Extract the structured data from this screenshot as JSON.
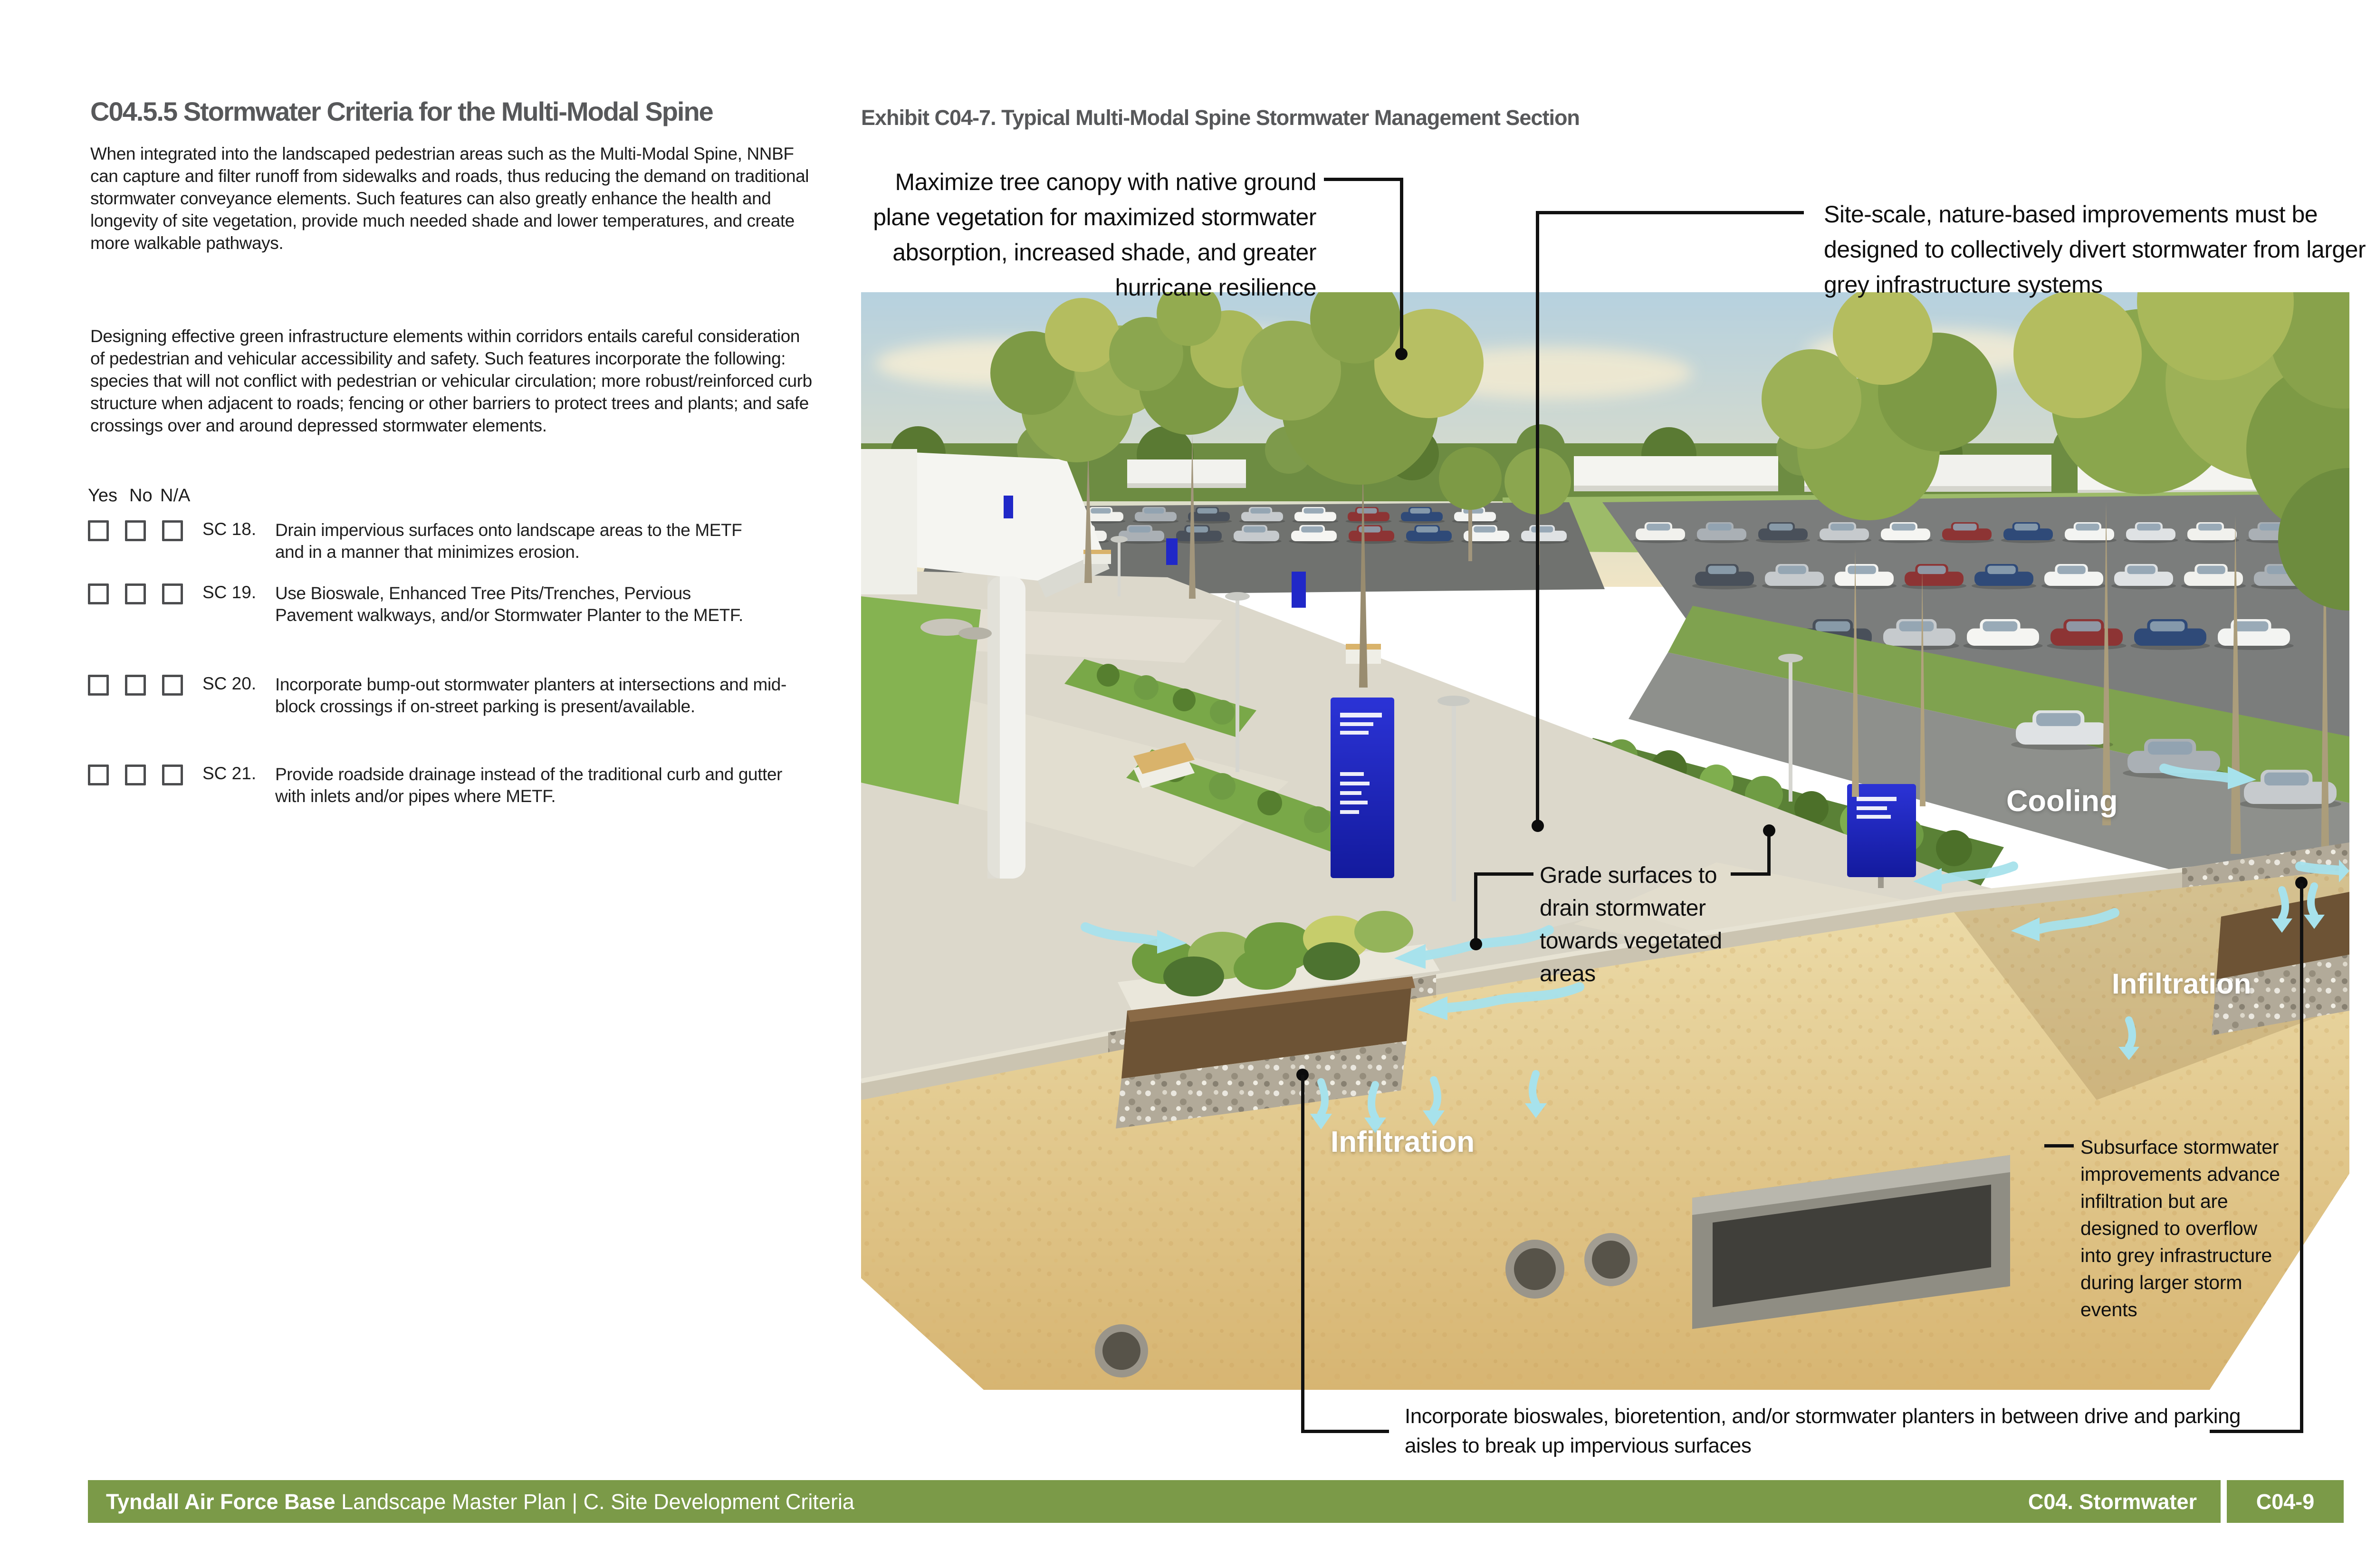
{
  "page": {
    "heading": "C04.5.5 Stormwater Criteria for the Multi-Modal Spine",
    "paragraphs": [
      "When integrated into the landscaped pedestrian areas such as the Multi-Modal Spine, NNBF can capture and filter runoff from sidewalks and roads, thus reducing the demand on traditional stormwater conveyance elements. Such features can also greatly enhance the health and longevity of site vegetation, provide much needed shade and lower temperatures, and create more walkable pathways.",
      "Designing effective green infrastructure elements within corridors entails careful consideration of pedestrian and vehicular accessibility and safety. Such features incorporate the following: species that will not conflict with pedestrian or vehicular circulation; more robust/reinforced curb structure when adjacent to roads; fencing or other barriers to protect trees and plants; and safe crossings over and around depressed stormwater elements."
    ],
    "checklist": {
      "column_headers": [
        "Yes",
        "No",
        "N/A"
      ],
      "items": [
        {
          "id": "SC 18.",
          "text": "Drain impervious surfaces onto landscape areas to the METF and in a manner that minimizes erosion."
        },
        {
          "id": "SC 19.",
          "text": "Use Bioswale, Enhanced Tree Pits/Trenches, Pervious Pavement walkways, and/or Stormwater Planter to the METF."
        },
        {
          "id": "SC 20.",
          "text": "Incorporate bump-out stormwater planters at intersections and mid-block crossings if on-street parking is present/available."
        },
        {
          "id": "SC 21.",
          "text": "Provide roadside drainage instead of the traditional curb and gutter with inlets and/or pipes where METF."
        }
      ]
    }
  },
  "exhibit": {
    "title": "Exhibit C04-7. Typical Multi-Modal Spine Stormwater Management Section",
    "annotations": {
      "tree_canopy": "Maximize tree canopy with native ground plane vegetation for maximized stormwater absorption, increased shade, and greater hurricane resilience",
      "site_scale": "Site-scale, nature-based improvements must be designed to collectively divert stormwater from larger grey infrastructure systems",
      "grade_surfaces": "Grade surfaces to drain stormwater towards vegetated areas",
      "subsurface": "Subsurface stormwater improvements advance infiltration but are designed to overflow into grey infrastructure during larger storm events",
      "bioswales": "Incorporate bioswales, bioretention, and/or stormwater planters in between drive and parking aisles to break up impervious surfaces"
    },
    "image_labels": {
      "cooling": "Cooling",
      "infiltration_left": "Infiltration",
      "infiltration_right": "Infiltration"
    }
  },
  "footer": {
    "org_bold": "Tyndall Air Force Base",
    "doc_rest": " Landscape Master Plan | C. Site Development Criteria",
    "section_label": "C04. Stormwater",
    "page_number": "C04-9"
  },
  "colors": {
    "accent_green": "#7b9a48",
    "heading_gray": "#57585a",
    "sign_blue": "#1f27c0",
    "arrow_cyan": "#a7e2ec",
    "callout_black": "#111111"
  }
}
